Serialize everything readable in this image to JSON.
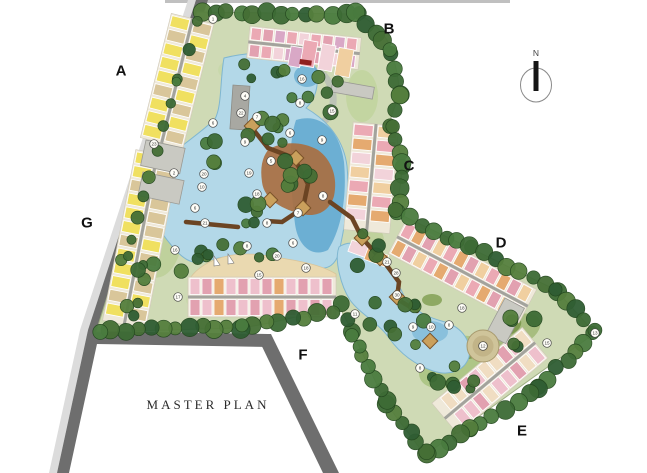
{
  "title": {
    "text": "MASTER PLAN",
    "x": 208,
    "y": 405
  },
  "compass": {
    "label": "N",
    "x": 536,
    "y": 85
  },
  "section_labels": [
    {
      "label": "A",
      "x": 121,
      "y": 71
    },
    {
      "label": "B",
      "x": 389,
      "y": 29
    },
    {
      "label": "C",
      "x": 409,
      "y": 166
    },
    {
      "label": "D",
      "x": 501,
      "y": 243
    },
    {
      "label": "E",
      "x": 522,
      "y": 431
    },
    {
      "label": "F",
      "x": 303,
      "y": 355
    },
    {
      "label": "G",
      "x": 87,
      "y": 223
    }
  ],
  "markers": [
    {
      "n": "1",
      "x": 213,
      "y": 19
    },
    {
      "n": "16",
      "x": 302,
      "y": 79
    },
    {
      "n": "4",
      "x": 245,
      "y": 96
    },
    {
      "n": "8",
      "x": 300,
      "y": 103
    },
    {
      "n": "15",
      "x": 332,
      "y": 111
    },
    {
      "n": "22",
      "x": 241,
      "y": 113
    },
    {
      "n": "7",
      "x": 257,
      "y": 117
    },
    {
      "n": "6",
      "x": 213,
      "y": 123
    },
    {
      "n": "6",
      "x": 290,
      "y": 133
    },
    {
      "n": "9",
      "x": 322,
      "y": 140
    },
    {
      "n": "23",
      "x": 154,
      "y": 144
    },
    {
      "n": "9",
      "x": 245,
      "y": 142
    },
    {
      "n": "5",
      "x": 271,
      "y": 161
    },
    {
      "n": "2",
      "x": 174,
      "y": 173
    },
    {
      "n": "20",
      "x": 204,
      "y": 174
    },
    {
      "n": "19",
      "x": 249,
      "y": 173
    },
    {
      "n": "10",
      "x": 202,
      "y": 187
    },
    {
      "n": "18",
      "x": 257,
      "y": 194
    },
    {
      "n": "8",
      "x": 323,
      "y": 196
    },
    {
      "n": "6",
      "x": 195,
      "y": 208
    },
    {
      "n": "7",
      "x": 298,
      "y": 213
    },
    {
      "n": "21",
      "x": 205,
      "y": 223
    },
    {
      "n": "8",
      "x": 267,
      "y": 223
    },
    {
      "n": "6",
      "x": 293,
      "y": 243
    },
    {
      "n": "8",
      "x": 247,
      "y": 246
    },
    {
      "n": "16",
      "x": 175,
      "y": 250
    },
    {
      "n": "20",
      "x": 277,
      "y": 256
    },
    {
      "n": "15",
      "x": 259,
      "y": 275
    },
    {
      "n": "18",
      "x": 306,
      "y": 268
    },
    {
      "n": "17",
      "x": 178,
      "y": 297
    },
    {
      "n": "21",
      "x": 387,
      "y": 262
    },
    {
      "n": "28",
      "x": 396,
      "y": 273
    },
    {
      "n": "30",
      "x": 397,
      "y": 295
    },
    {
      "n": "11",
      "x": 355,
      "y": 314
    },
    {
      "n": "18",
      "x": 462,
      "y": 308
    },
    {
      "n": "9",
      "x": 413,
      "y": 327
    },
    {
      "n": "10",
      "x": 431,
      "y": 327
    },
    {
      "n": "8",
      "x": 449,
      "y": 325
    },
    {
      "n": "12",
      "x": 483,
      "y": 346
    },
    {
      "n": "15",
      "x": 547,
      "y": 343
    },
    {
      "n": "13",
      "x": 595,
      "y": 333
    },
    {
      "n": "8",
      "x": 420,
      "y": 368
    }
  ],
  "colors": {
    "road": "#6e6e6e",
    "road_edge": "#dcdcdc",
    "top_strip": "#c0c0c0",
    "site": "#cfdab5",
    "water": "#b3d8e8",
    "water_deep": "#5fa8cf",
    "water_edge": "#7fb6d0",
    "beach": "#ead9b0",
    "deck": "#a96f41",
    "boardwalk": "#6b4423",
    "pavilion": "#caa05c",
    "gray_building": "#c9c9c2",
    "spine": "#a3a39d",
    "marker_fill": "#fffef8",
    "label_color": "#111111",
    "tree_palette": [
      "#3d6b35",
      "#4a7c3f",
      "#2f5d33",
      "#557f3d",
      "#456f35"
    ],
    "building_palette": {
      "yellow": "#f0e060",
      "tan": "#d9c69a",
      "salmon": "#eba9b4",
      "rose": "#e2a1b0",
      "pink": "#eec0cc",
      "lightpink": "#f2d3da",
      "orange": "#e5aa70",
      "peach": "#f0cfa0",
      "mauve": "#d9a8c6",
      "cream": "#f0ddc2"
    }
  }
}
